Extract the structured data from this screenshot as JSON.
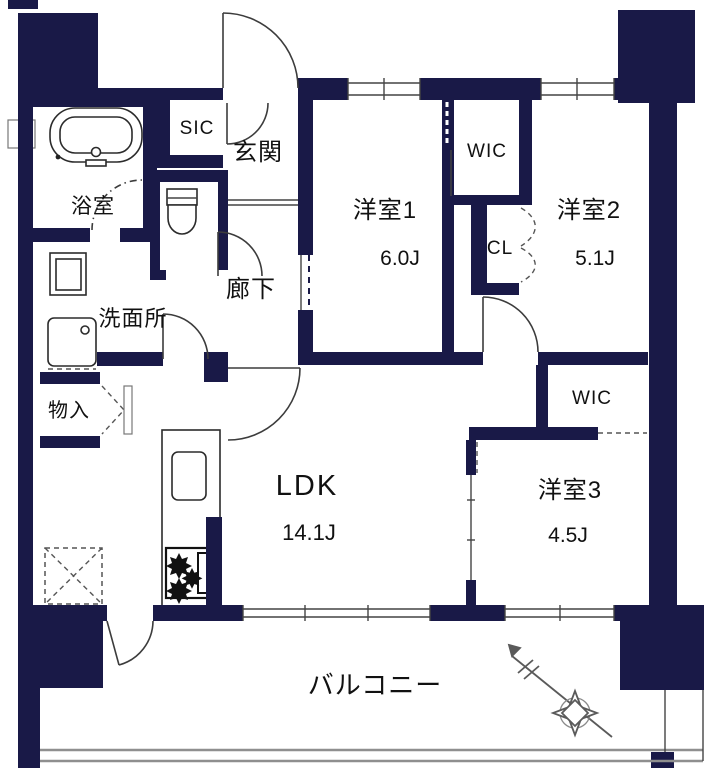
{
  "plan_type": "floor-plan",
  "rooms": {
    "genkan": {
      "label": "玄関"
    },
    "sic": {
      "label": "SIC"
    },
    "hallway": {
      "label": "廊下"
    },
    "bathroom": {
      "label": "浴室"
    },
    "washroom": {
      "label": "洗面所"
    },
    "storage": {
      "label": "物入"
    },
    "bedroom1": {
      "label": "洋室1",
      "size": "6.0J"
    },
    "wic1": {
      "label": "WIC"
    },
    "closet": {
      "label": "CL"
    },
    "bedroom2": {
      "label": "洋室2",
      "size": "5.1J"
    },
    "wic2": {
      "label": "WIC"
    },
    "bedroom3": {
      "label": "洋室3",
      "size": "4.5J"
    },
    "ldk": {
      "label": "LDK",
      "size": "14.1J"
    },
    "balcony": {
      "label": "バルコニー"
    }
  },
  "colors": {
    "wall": "#191947",
    "line": "#3c3c3c",
    "railing": "#8f8f8f",
    "background": "#ffffff"
  },
  "icons": [
    "bathtub-icon",
    "toilet-icon",
    "vanity-icon",
    "washing-machine-pan-icon",
    "kitchen-sink-icon",
    "stove-icon",
    "void-cross-box-icon",
    "compass-rose-icon"
  ]
}
